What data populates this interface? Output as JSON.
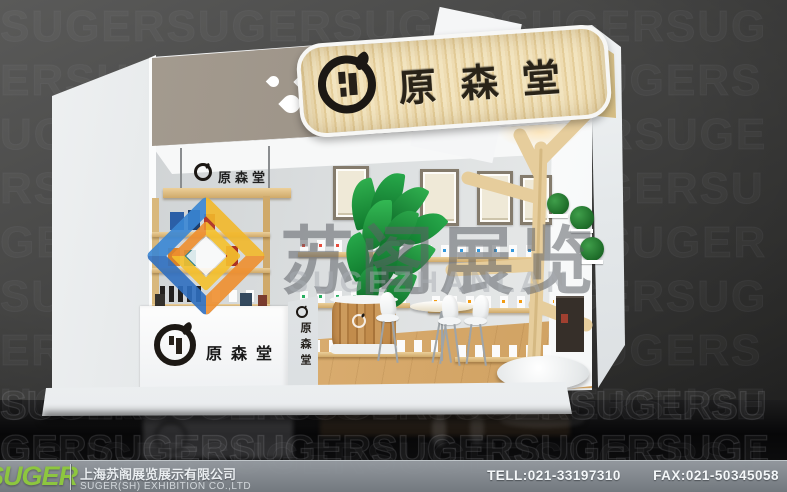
{
  "booth": {
    "fascia_sign_text": "原森堂",
    "hanging_sign_text": "原森堂",
    "counter_sign_text": "原森堂",
    "counter_side_text": "原森堂",
    "wood_color": "#e8d6ac",
    "logo_color": "#1c1814"
  },
  "watermark": {
    "cn_text": "苏阁展览",
    "en_text": "SUGEZHANLAN",
    "pattern_word": "SUGER",
    "logo_colors": {
      "blue": "#3a87d4",
      "deep_blue": "#2f6fc0",
      "yellow": "#f6c12d",
      "orange": "#ef8f2f"
    }
  },
  "footer": {
    "brand": "SUGER",
    "brand_color": "#8dc63f",
    "company_cn": "上海苏阁展览展示有限公司",
    "company_en": "SUGER(SH) EXHIBITION CO.,LTD",
    "tel": "TELL:021-33197310",
    "fax": "FAX:021-50345058"
  }
}
